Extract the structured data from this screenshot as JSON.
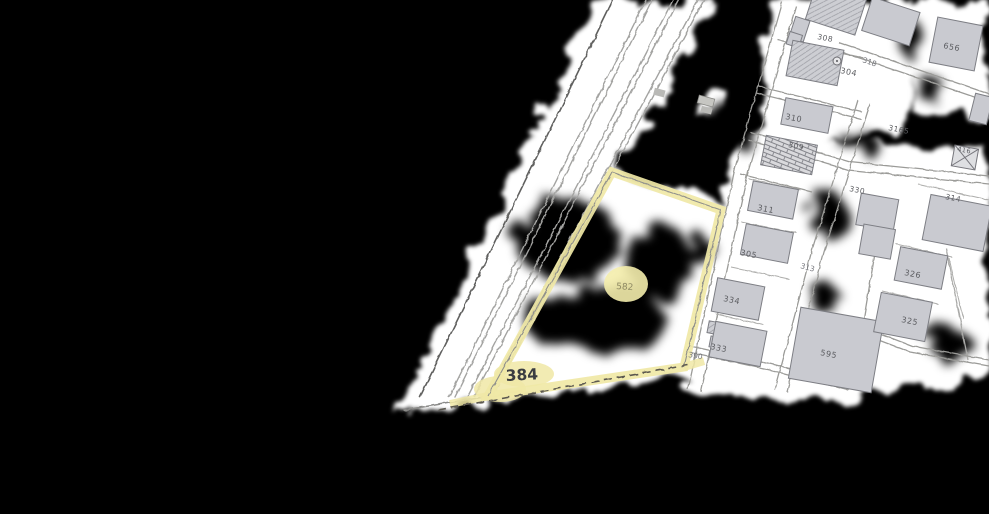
{
  "map": {
    "type": "cadastral-plan-scan",
    "background_color": "#000000",
    "paper_color": "#ffffff",
    "highlight_color": "#f0e8a6",
    "building_fill": "#c9cad0",
    "line_color": "#9b9b98",
    "highlighted_parcel": {
      "number": "384",
      "inner_number": "582"
    },
    "labels": {
      "p384": "384",
      "p582": "582",
      "p310": "310",
      "p309": "309",
      "p304": "304",
      "p308": "308",
      "p656": "656",
      "p311": "311",
      "p305": "305",
      "p334": "334",
      "p333": "333",
      "p330": "330",
      "p326": "326",
      "p325": "325",
      "p314": "314",
      "p595": "595",
      "p3165": "3165",
      "p416": "416",
      "r318": "318",
      "r313": "313",
      "r390": "390"
    }
  }
}
